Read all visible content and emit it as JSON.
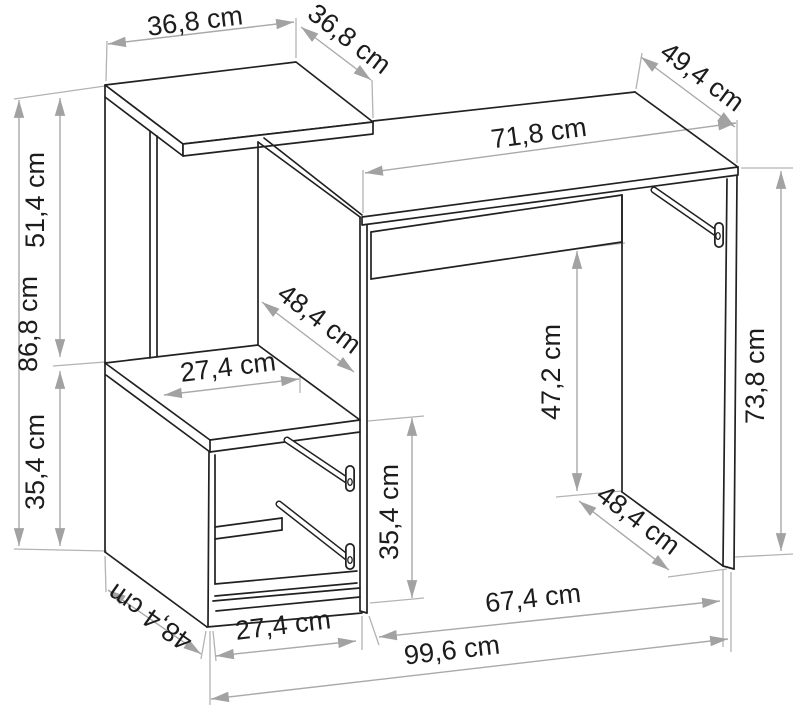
{
  "diagram": {
    "type": "furniture technical dimension drawing",
    "subject": "desk with side shelf tower and drawer cabinet",
    "unit": "cm",
    "colors": {
      "outline": "#212121",
      "dimension_lines": "#a9a9a9",
      "background": "#ffffff"
    },
    "dimensions": {
      "top_shelf_width": "36,8 cm",
      "top_shelf_depth": "36,8 cm",
      "desktop_width": "71,8 cm",
      "desktop_depth": "49,4 cm",
      "upper_shelf_height": "51,4 cm",
      "left_unit_height": "86,8 cm",
      "left_cabinet_height": "35,4 cm",
      "middle_shelf_depth": "48,4 cm",
      "middle_shelf_width": "27,4 cm",
      "knee_space_height": "47,2 cm",
      "cabinet_opening_height": "35,4 cm",
      "desk_height": "73,8 cm",
      "desk_side_depth": "48,4 cm",
      "cabinet_base_depth": "48,4 cm",
      "cabinet_base_width": "27,4 cm",
      "desk_base_width": "67,4 cm",
      "total_width": "99,6 cm"
    }
  }
}
